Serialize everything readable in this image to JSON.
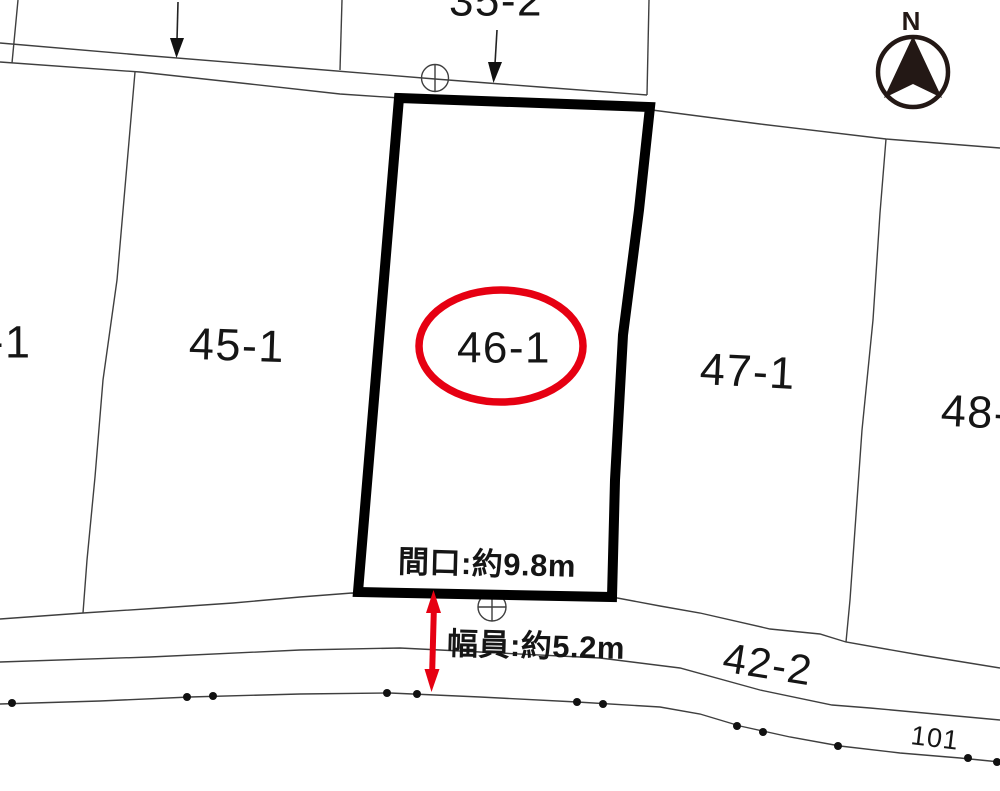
{
  "map": {
    "parcel_labels": {
      "left_partial": "-1",
      "p45": "45-1",
      "p46": "46-1",
      "p47": "47-1",
      "p48_partial": "48-",
      "p35_partial": "35-2",
      "p42": "42-2"
    },
    "road_point_number": "101",
    "measurements": {
      "frontage": "間口:約9.8m",
      "road_width": "幅員:約5.2m"
    },
    "compass": {
      "north_label": "N"
    },
    "colors": {
      "highlight_red": "#e60012",
      "boundary_line": "#3f3f3f",
      "parcel_outline": "#000000",
      "compass_ink": "#231815"
    }
  }
}
